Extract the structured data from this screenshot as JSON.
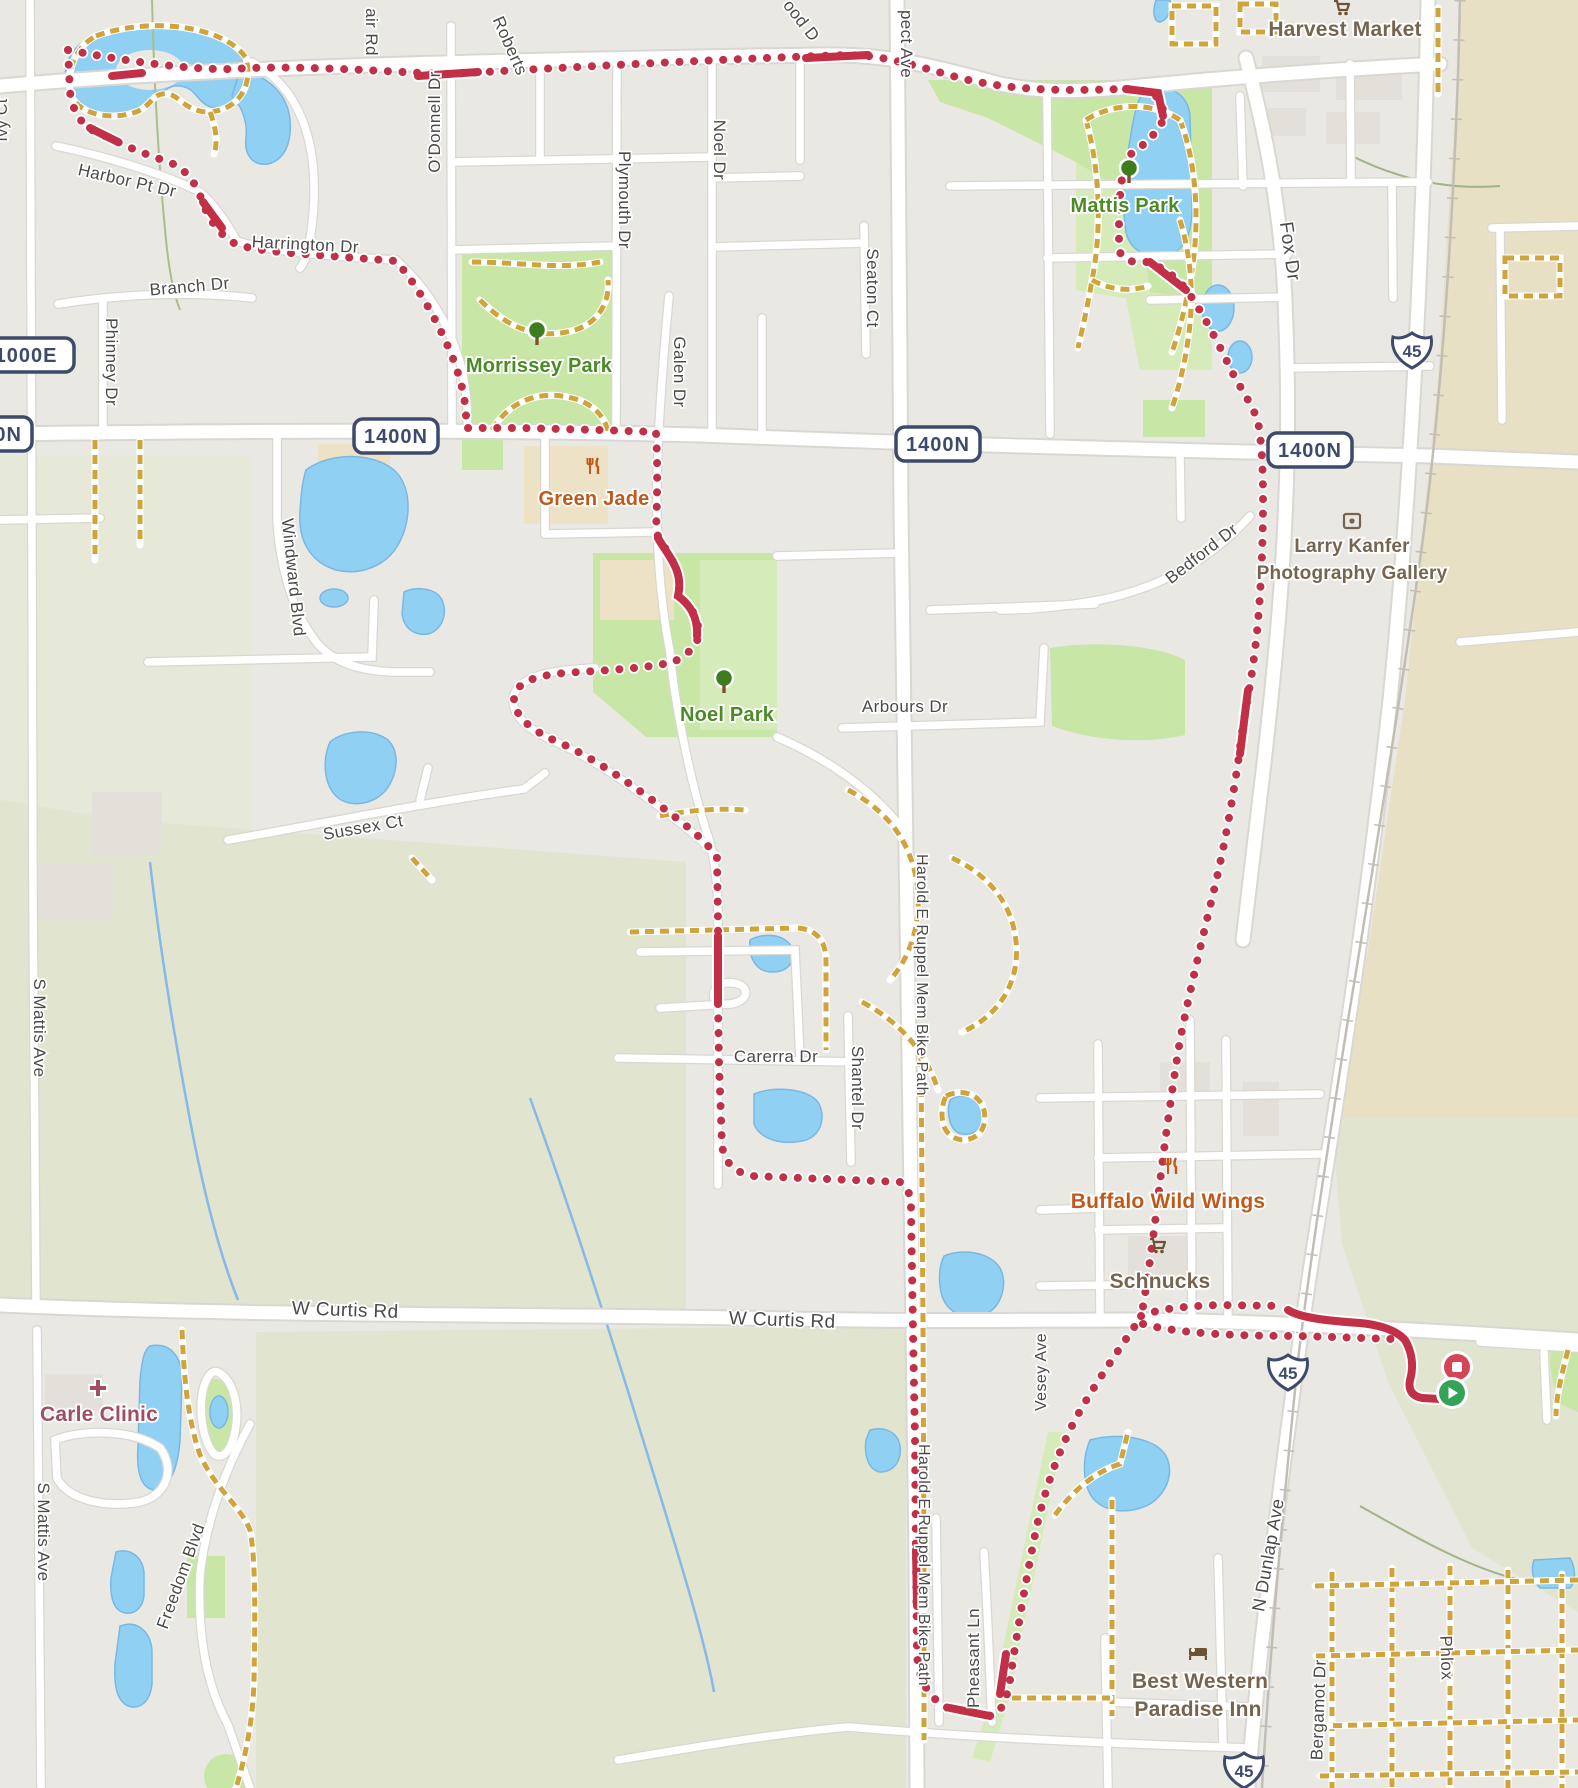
{
  "app": {
    "name": "route-map-view"
  },
  "map": {
    "colors": {
      "bg": "#EAE8E3",
      "field": "#E1E4CE",
      "fieldLight": "#E6E8D8",
      "tan": "#E7E0C4",
      "park": "#C8E6A6",
      "parkLight": "#DBEFC2",
      "water": "#8FD0F3",
      "waterEdge": "#7AB8E4",
      "road": "#FFFFFF",
      "casing": "#D9D7D1",
      "gold": "#CFA43C",
      "rail": "#C2BEB6",
      "route": "#C23048",
      "marker_stop": "#D5455A",
      "marker_start": "#33A457",
      "badge_navy": "#3E4A6C",
      "street_gray": "#4A4A4A",
      "poi_green": "#4C8A26",
      "poi_orange": "#C05A1C",
      "poi_brown": "#75654F",
      "poi_plum": "#A04F61",
      "building": "#E3E0DA",
      "beige": "#EDE2C6"
    },
    "street_labels": [
      {
        "text": "air Rd",
        "x": 366,
        "y": 32,
        "rot": 90,
        "size": 17
      },
      {
        "text": "Roberts",
        "x": 505,
        "y": 48,
        "rot": 66,
        "size": 17
      },
      {
        "text": "ood D",
        "x": 797,
        "y": 24,
        "rot": 52,
        "size": 17
      },
      {
        "text": "pect Ave",
        "x": 901,
        "y": 44,
        "rot": 90,
        "size": 17
      },
      {
        "text": "O'Donnell Dr",
        "x": 440,
        "y": 122,
        "rot": -90,
        "size": 17
      },
      {
        "text": "Ivy Ct",
        "x": 7,
        "y": 120,
        "rot": -90,
        "size": 16
      },
      {
        "text": "Harbor Pt Dr",
        "x": 126,
        "y": 186,
        "rot": 13,
        "size": 17
      },
      {
        "text": "Harrington Dr",
        "x": 305,
        "y": 250,
        "rot": 3,
        "size": 17
      },
      {
        "text": "Branch Dr",
        "x": 190,
        "y": 292,
        "rot": -5,
        "size": 17
      },
      {
        "text": "Phinney Dr",
        "x": 106,
        "y": 362,
        "rot": 90,
        "size": 17
      },
      {
        "text": "Plymouth Dr",
        "x": 619,
        "y": 200,
        "rot": 90,
        "size": 17
      },
      {
        "text": "Noel Dr",
        "x": 714,
        "y": 150,
        "rot": 90,
        "size": 17
      },
      {
        "text": "Seaton Ct",
        "x": 867,
        "y": 288,
        "rot": 90,
        "size": 17
      },
      {
        "text": "Galen Dr",
        "x": 674,
        "y": 372,
        "rot": 90,
        "size": 17
      },
      {
        "text": "Windward Blvd",
        "x": 288,
        "y": 578,
        "rot": 84,
        "size": 17
      },
      {
        "text": "Sussex Ct",
        "x": 364,
        "y": 833,
        "rot": -10,
        "size": 17
      },
      {
        "text": "S Mattis Ave",
        "x": 34,
        "y": 1028,
        "rot": 90,
        "size": 17
      },
      {
        "text": "S Mattis Ave",
        "x": 38,
        "y": 1532,
        "rot": 90,
        "size": 17
      },
      {
        "text": "Freedom Blvd",
        "x": 186,
        "y": 1578,
        "rot": -70,
        "size": 17
      },
      {
        "text": "W Curtis Rd",
        "x": 345,
        "y": 1316,
        "rot": 2,
        "size": 19
      },
      {
        "text": "W Curtis Rd",
        "x": 782,
        "y": 1326,
        "rot": 2,
        "size": 19
      },
      {
        "text": "Carerra Dr",
        "x": 776,
        "y": 1062,
        "rot": 0,
        "size": 17
      },
      {
        "text": "Shantel Dr",
        "x": 852,
        "y": 1088,
        "rot": 90,
        "size": 17
      },
      {
        "text": "Harold E Ruppel Mem Bike Path",
        "x": 917,
        "y": 975,
        "rot": 90,
        "size": 16
      },
      {
        "text": "Harold E Ruppel Mem Bike Path",
        "x": 919,
        "y": 1565,
        "rot": 90,
        "size": 16
      },
      {
        "text": "Pheasant Ln",
        "x": 979,
        "y": 1658,
        "rot": -90,
        "size": 17
      },
      {
        "text": "Vesey Ave",
        "x": 1046,
        "y": 1372,
        "rot": -90,
        "size": 16
      },
      {
        "text": "Fox Dr",
        "x": 1284,
        "y": 252,
        "rot": 82,
        "size": 19
      },
      {
        "text": "Bedford Dr",
        "x": 1205,
        "y": 558,
        "rot": -38,
        "size": 17
      },
      {
        "text": "Arbours Dr",
        "x": 905,
        "y": 712,
        "rot": 0,
        "size": 17
      },
      {
        "text": "N Dunlap Ave",
        "x": 1274,
        "y": 1556,
        "rot": -80,
        "size": 18
      },
      {
        "text": "Bergamot Dr",
        "x": 1324,
        "y": 1710,
        "rot": -88,
        "size": 17
      },
      {
        "text": "Phlox",
        "x": 1441,
        "y": 1658,
        "rot": 88,
        "size": 17
      }
    ],
    "poi_labels": [
      {
        "text": "Harvest Market",
        "x": 1345,
        "y": 36,
        "color": "brown",
        "size": 21,
        "icon": "cart",
        "icon_x": 1342,
        "icon_y": 8
      },
      {
        "text": "Mattis Park",
        "x": 1125,
        "y": 212,
        "color": "green",
        "size": 20,
        "icon": "tree",
        "icon_x": 1129,
        "icon_y": 172
      },
      {
        "text": "Morrissey Park",
        "x": 539,
        "y": 372,
        "color": "green",
        "size": 20,
        "icon": "tree",
        "icon_x": 537,
        "icon_y": 334
      },
      {
        "text": "Noel Park",
        "x": 727,
        "y": 721,
        "color": "green",
        "size": 20,
        "icon": "tree",
        "icon_x": 724,
        "icon_y": 682
      },
      {
        "text": "Green Jade",
        "x": 594,
        "y": 505,
        "color": "orange",
        "size": 20,
        "icon": "food",
        "icon_x": 594,
        "icon_y": 466
      },
      {
        "text": "Larry Kanfer",
        "x": 1352,
        "y": 552,
        "color": "brown",
        "size": 19,
        "icon": "gallery",
        "icon_x": 1352,
        "icon_y": 521
      },
      {
        "text": "Photography Gallery",
        "x": 1352,
        "y": 579,
        "color": "brown",
        "size": 19
      },
      {
        "text": "Buffalo Wild Wings",
        "x": 1168,
        "y": 1208,
        "color": "orange",
        "size": 21,
        "icon": "food",
        "icon_x": 1172,
        "icon_y": 1166
      },
      {
        "text": "Schnucks",
        "x": 1160,
        "y": 1288,
        "color": "brown",
        "size": 21,
        "icon": "cart",
        "icon_x": 1158,
        "icon_y": 1246
      },
      {
        "text": "Carle Clinic",
        "x": 99,
        "y": 1421,
        "color": "plum",
        "size": 21,
        "icon": "cross",
        "icon_x": 98,
        "icon_y": 1388
      },
      {
        "text": "Best Western",
        "x": 1200,
        "y": 1688,
        "color": "brown",
        "size": 21,
        "icon": "bed",
        "icon_x": 1198,
        "icon_y": 1652
      },
      {
        "text": "Paradise Inn",
        "x": 1198,
        "y": 1716,
        "color": "brown",
        "size": 21
      }
    ],
    "badges": [
      {
        "text": "1000E",
        "x": 26,
        "y": 355,
        "w": 96
      },
      {
        "text": "1400N",
        "x": -10,
        "y": 434,
        "w": 84
      },
      {
        "text": "1400N",
        "x": 396,
        "y": 436,
        "w": 84
      },
      {
        "text": "1400N",
        "x": 938,
        "y": 444,
        "w": 84
      },
      {
        "text": "1400N",
        "x": 1310,
        "y": 450,
        "w": 84
      }
    ],
    "shields": [
      {
        "text": "45",
        "x": 1412,
        "y": 350
      },
      {
        "text": "45",
        "x": 1288,
        "y": 1372
      },
      {
        "text": "45",
        "x": 1244,
        "y": 1770
      }
    ],
    "markers": {
      "stop": {
        "x": 1457,
        "y": 1367
      },
      "start": {
        "x": 1452,
        "y": 1393
      }
    }
  }
}
